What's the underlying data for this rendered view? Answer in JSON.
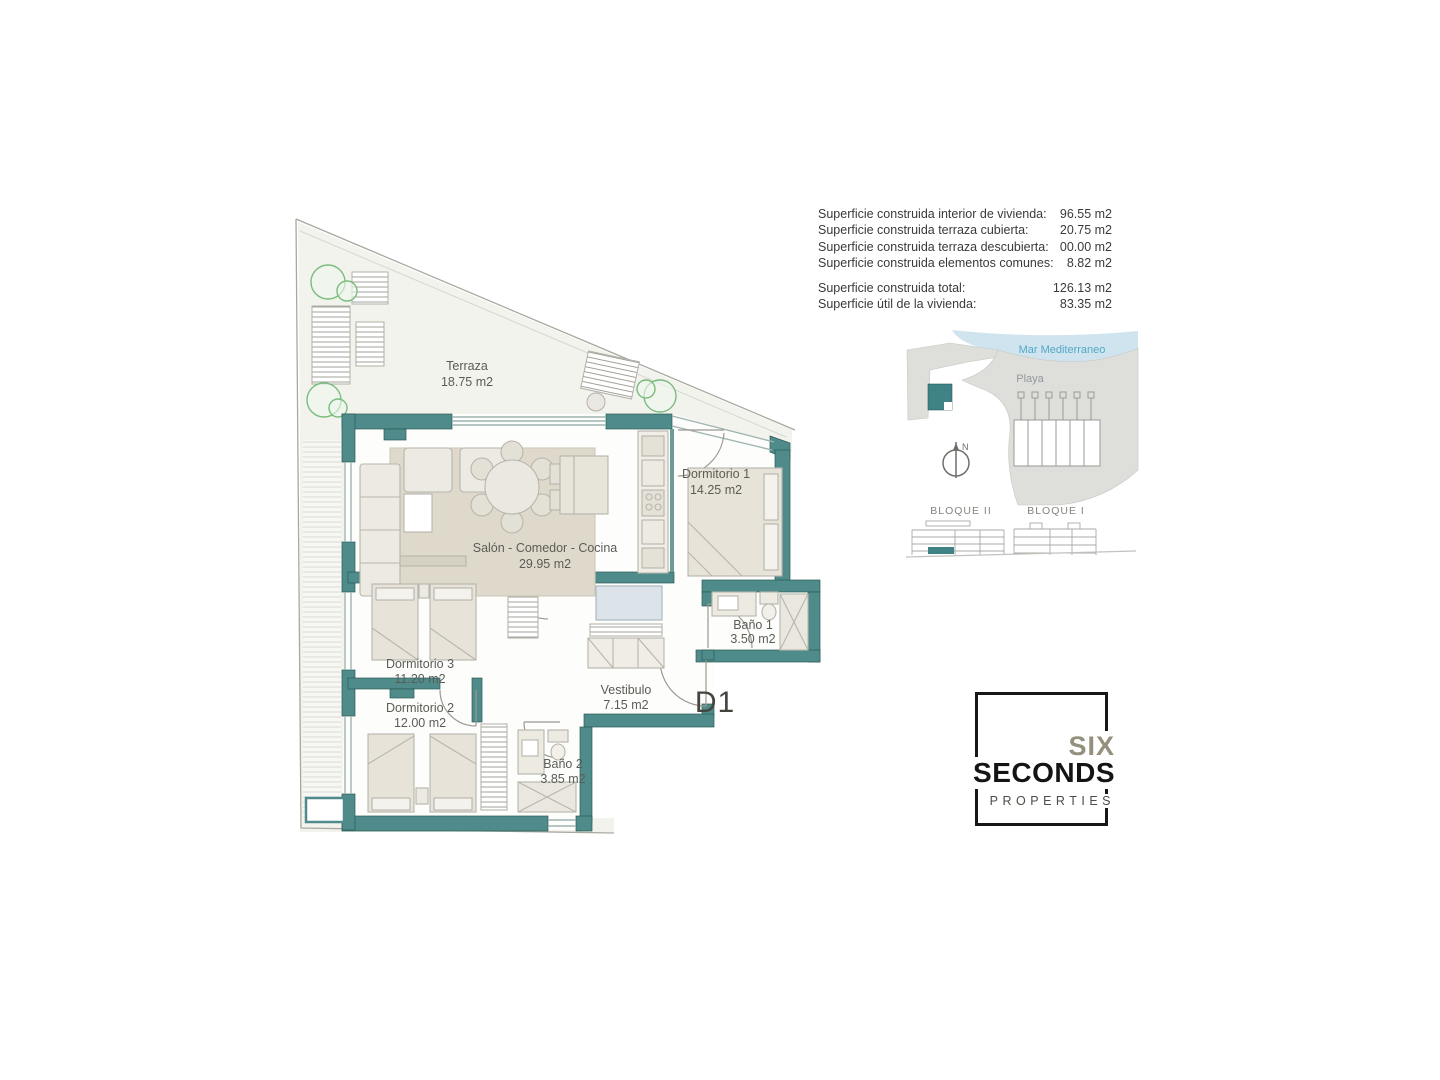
{
  "surface_table": {
    "rows": [
      {
        "label": "Superficie construida interior de vivienda:",
        "value": "96.55 m2"
      },
      {
        "label": "Superficie construida terraza cubierta:",
        "value": "20.75 m2"
      },
      {
        "label": "Superficie construida terraza descubierta:",
        "value": "00.00 m2"
      },
      {
        "label": "Superficie construida elementos comunes:",
        "value": "8.82 m2"
      }
    ],
    "totals": [
      {
        "label": "Superficie construida total:",
        "value": "126.13 m2"
      },
      {
        "label": "Superficie útil de la vivienda:",
        "value": "83.35 m2"
      }
    ]
  },
  "plan": {
    "unit_label": "D1",
    "rooms": [
      {
        "name": "Terraza",
        "area": "18.75 m2"
      },
      {
        "name": "Salón - Comedor - Cocina",
        "area": "29.95 m2"
      },
      {
        "name": "Dormitorio 1",
        "area": "14.25 m2"
      },
      {
        "name": "Baño 1",
        "area": "3.50 m2"
      },
      {
        "name": "Dormitorio 3",
        "area": "11.20 m2"
      },
      {
        "name": "Dormitorio 2",
        "area": "12.00 m2"
      },
      {
        "name": "Vestibulo",
        "area": "7.15 m2"
      },
      {
        "name": "Baño 2",
        "area": "3.85 m2"
      }
    ]
  },
  "site_map": {
    "sea_label": "Mar Mediterraneo",
    "beach_label": "Playa",
    "compass_label": "N",
    "blocks": [
      {
        "label": "BLOQUE II"
      },
      {
        "label": "BLOQUE I"
      }
    ]
  },
  "logo": {
    "line1": "SIX",
    "line2": "SECONDS",
    "line3": "PROPERTIES"
  },
  "colors": {
    "wall_teal": "#4e8b8a",
    "unit_teal": "#3f8387",
    "sea_blue": "#cfe4ef",
    "sea_label_blue": "#54a8c6",
    "logo_tan": "#95907e",
    "tree_green": "#79bd7c"
  }
}
